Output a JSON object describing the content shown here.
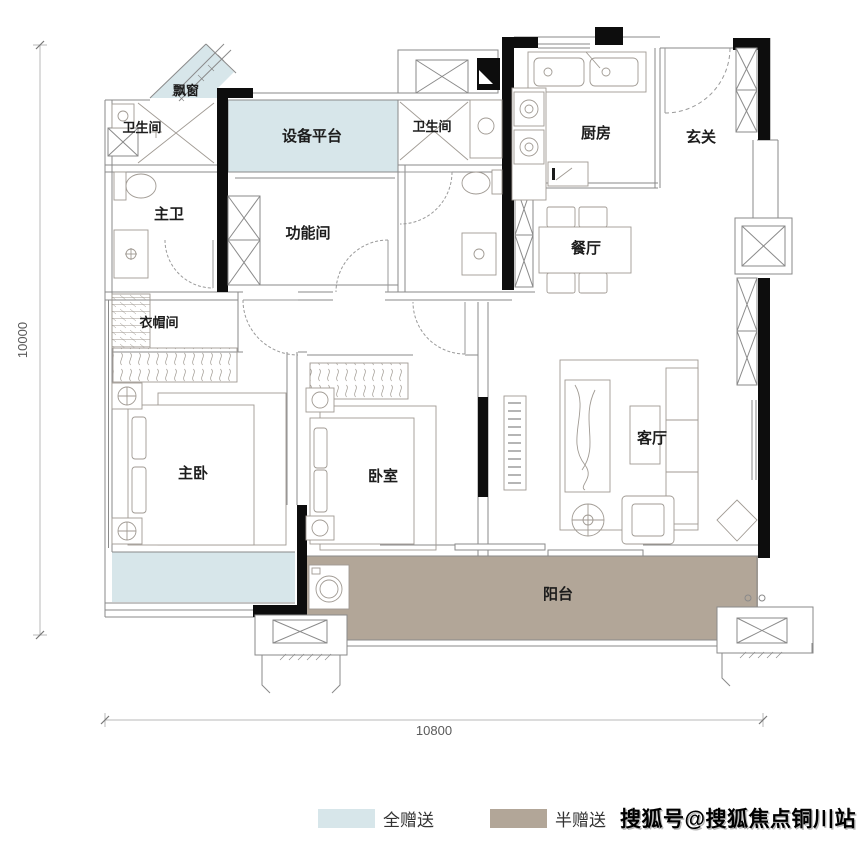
{
  "rooms": [
    {
      "key": "bay-window",
      "label": "飘窗"
    },
    {
      "key": "bathroom-1",
      "label": "卫生间"
    },
    {
      "key": "equipment-platform",
      "label": "设备平台"
    },
    {
      "key": "bathroom-2",
      "label": "卫生间"
    },
    {
      "key": "kitchen",
      "label": "厨房"
    },
    {
      "key": "foyer",
      "label": "玄关"
    },
    {
      "key": "master-bathroom",
      "label": "主卫"
    },
    {
      "key": "function-room",
      "label": "功能间"
    },
    {
      "key": "dining-room",
      "label": "餐厅"
    },
    {
      "key": "cloakroom",
      "label": "衣帽间"
    },
    {
      "key": "master-bedroom",
      "label": "主卧"
    },
    {
      "key": "bedroom",
      "label": "卧室"
    },
    {
      "key": "living-room",
      "label": "客厅"
    },
    {
      "key": "balcony",
      "label": "阳台"
    }
  ],
  "dimensions": {
    "left": "10000",
    "bottom": "10800"
  },
  "legend": [
    {
      "key": "full-gift",
      "label": "全赠送",
      "color": "#d7e6ea"
    },
    {
      "key": "half-gift",
      "label": "半赠送",
      "color": "#b2a698"
    }
  ],
  "watermark": "搜狐号@搜狐焦点铜川站",
  "colors": {
    "full_gift": "#d7e6ea",
    "half_gift": "#b2a698",
    "wall": "#0d0d0d",
    "thin_line": "#8a8a8a",
    "furniture": "#a09a93"
  }
}
